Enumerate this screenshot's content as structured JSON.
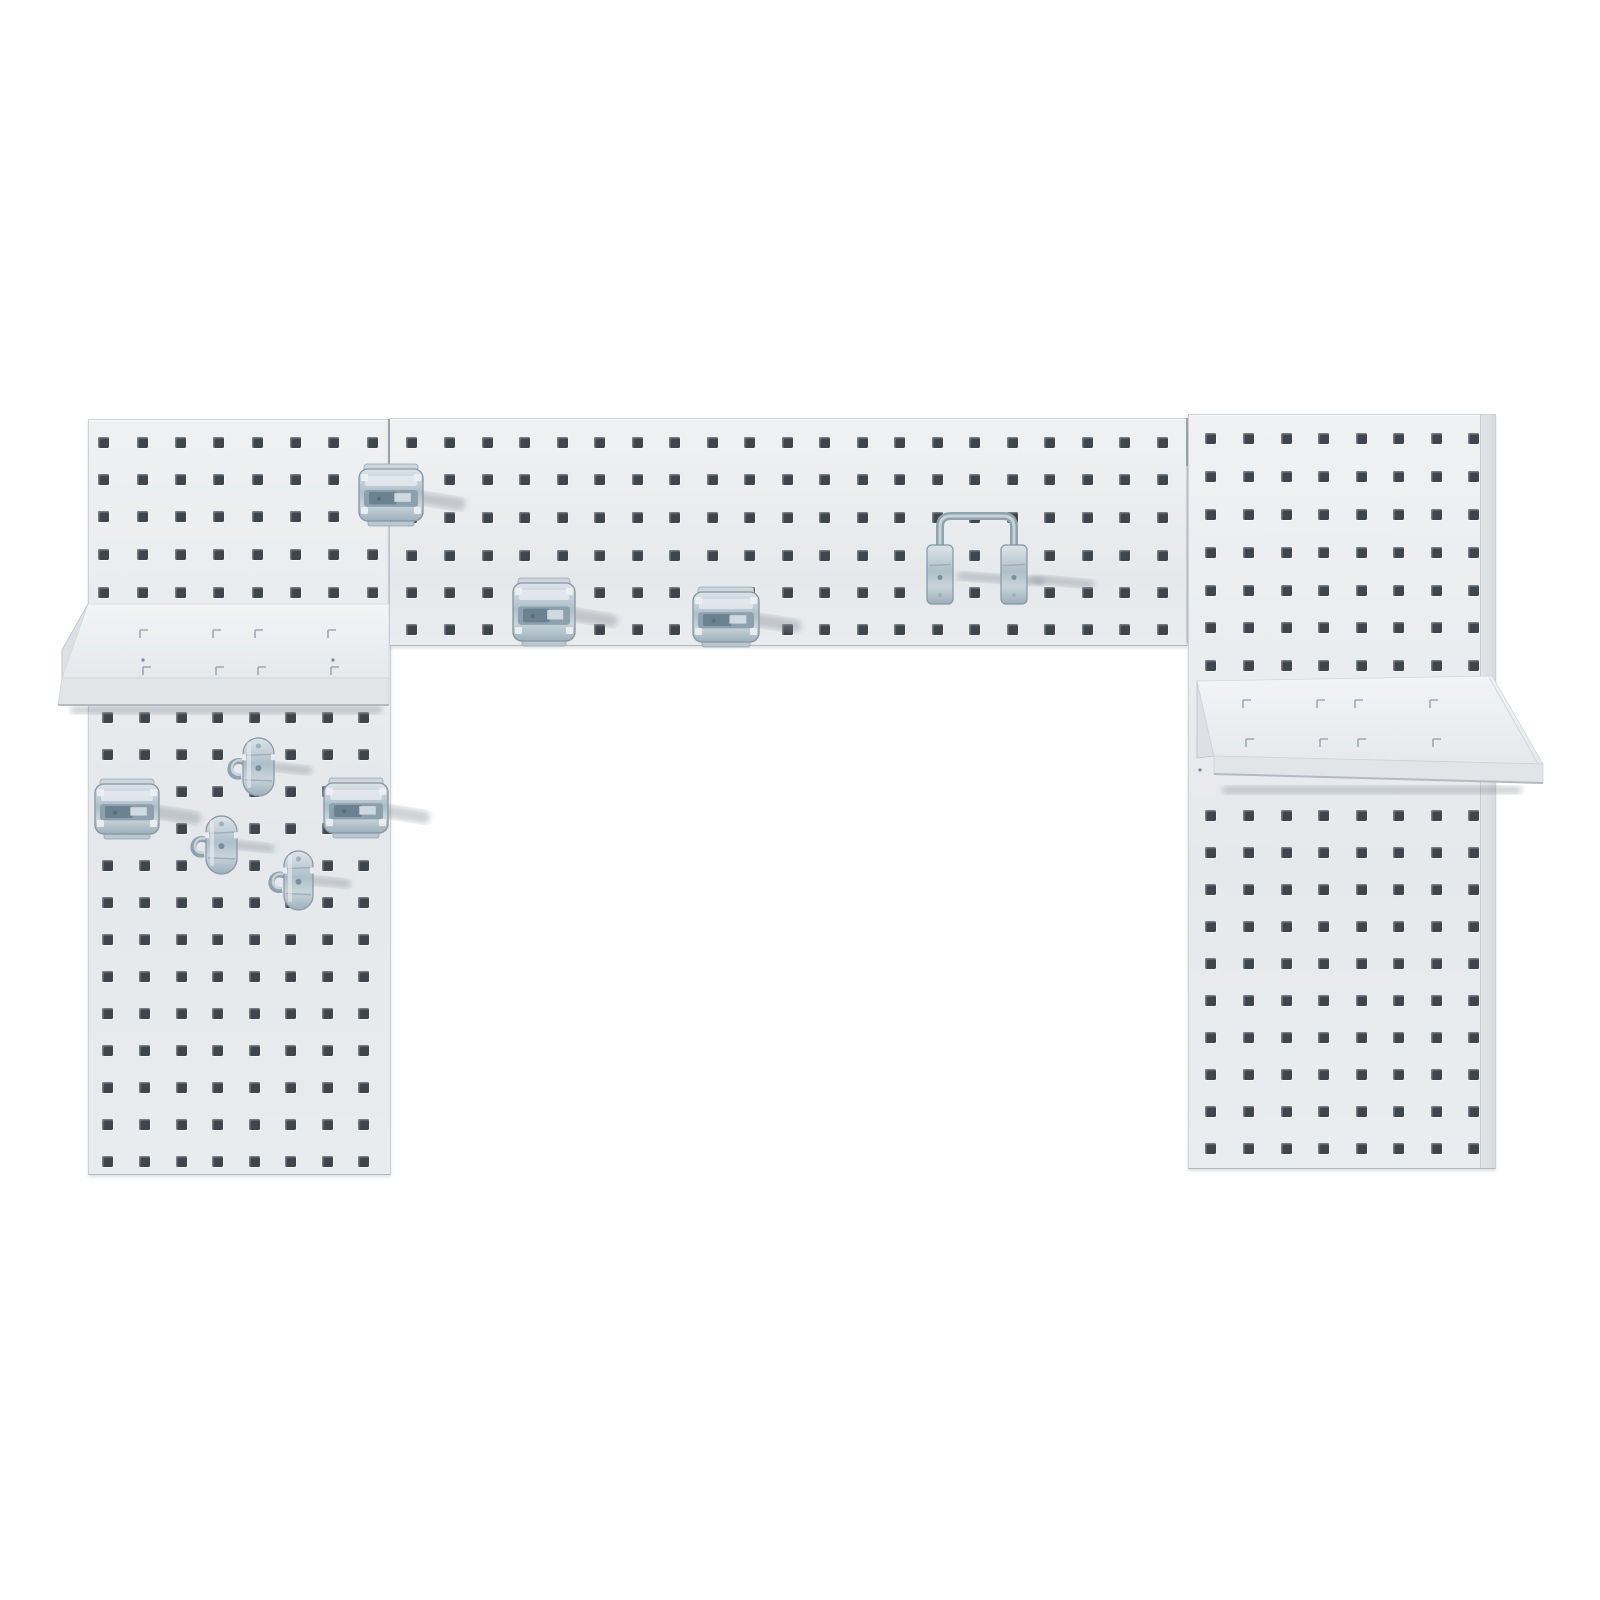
{
  "scene": {
    "background_color": "#ffffff",
    "board_color": "#e9ebed",
    "board_edge_color": "#ccd1d6",
    "hole_color": "#3f454c",
    "metal_light": "#dce4e9",
    "metal_mid": "#aebfc9",
    "metal_dark": "#8fa2ae",
    "shadow_color": "rgba(128,138,148,0.38)"
  },
  "logo": {
    "text": "LocBoard",
    "tagline": "A TRITON METAL PRODUCTS INNOVATION",
    "color": "#4a74b2",
    "tagline_color": "#5f6a76"
  },
  "panels": [
    {
      "name": "pegboard-panel-left",
      "x": 88,
      "y": 419,
      "w": 301,
      "h": 754,
      "bg": "linear-gradient(180deg,#eef0f2,#e5e8eb 55%,#e9ecee)"
    },
    {
      "name": "pegboard-panel-center",
      "x": 389,
      "y": 418,
      "w": 797,
      "h": 226,
      "bg": "linear-gradient(180deg,#f0f1f3,#e6e9eb 70%,#e9ebee)"
    },
    {
      "name": "pegboard-panel-right",
      "x": 1188,
      "y": 414,
      "w": 306,
      "h": 753,
      "bg": "linear-gradient(180deg,#eff1f3,#e6e9ec 60%,#eaedef)",
      "flange_w": 14
    }
  ],
  "hole": {
    "size": 11
  },
  "hole_grids": [
    {
      "name": "holes-left-upper",
      "cols": [
        98,
        137,
        175,
        213,
        252,
        290,
        328,
        367
      ],
      "rows": [
        437,
        474,
        511,
        549,
        587
      ]
    },
    {
      "name": "holes-left-lower",
      "cols": [
        102,
        139,
        176,
        212,
        249,
        285,
        322,
        358
      ],
      "rows": [
        712,
        749,
        786,
        823,
        860,
        897,
        934,
        971,
        1008,
        1045,
        1082,
        1119,
        1156
      ]
    },
    {
      "name": "holes-center",
      "cols": [
        406,
        444,
        482,
        519,
        557,
        594,
        632,
        669,
        707,
        744,
        782,
        819,
        857,
        894,
        932,
        969,
        1007,
        1044,
        1082,
        1119,
        1157
      ],
      "rows": [
        437,
        474,
        512,
        550,
        587,
        624
      ]
    },
    {
      "name": "holes-right-upper",
      "cols": [
        1205,
        1243,
        1281,
        1318,
        1356,
        1393,
        1431,
        1468
      ],
      "rows": [
        433,
        471,
        509,
        547,
        585,
        622,
        660
      ]
    },
    {
      "name": "holes-right-lower",
      "cols": [
        1205,
        1243,
        1281,
        1318,
        1356,
        1393,
        1431,
        1468
      ],
      "rows": [
        810,
        847,
        884,
        921,
        958,
        995,
        1032,
        1069,
        1106,
        1143
      ]
    }
  ],
  "seams": [
    {
      "name": "panel-seam-left-center",
      "x": 389,
      "y1": 419,
      "y2": 643
    },
    {
      "name": "panel-seam-center-right",
      "x": 1187,
      "y1": 418,
      "y2": 643
    }
  ],
  "shelves": [
    {
      "name": "metal-shelf-left",
      "surface": "88,604 389,604 389,678 62,678",
      "lip": "62,678 389,678 389,705 58,705",
      "lip_bottom": "58,705 389,705",
      "bracket": "88,604 88,678 62,678 62,650",
      "shadow": {
        "x": 70,
        "y": 706,
        "w": 312,
        "h": 8
      },
      "slot_rows": [
        {
          "y": 630,
          "xs": [
            140,
            213,
            255,
            328
          ]
        },
        {
          "y": 667,
          "xs": [
            143,
            216,
            258,
            331
          ]
        }
      ],
      "dots": [
        {
          "x": 143,
          "y": 660
        },
        {
          "x": 333,
          "y": 660
        }
      ]
    },
    {
      "name": "metal-shelf-right",
      "surface": "1197,681 1492,676 1543,764 1214,756",
      "lip": "1214,756 1543,764 1543,783 1214,774",
      "lip_bottom": "1214,774 1543,783",
      "bracket": "1197,681 1214,756 1197,758",
      "fold_line": "1489,677 1538,764",
      "shadow": {
        "x": 1222,
        "y": 786,
        "w": 300,
        "h": 8
      },
      "slot_rows": [
        {
          "y": 700,
          "xs": [
            1243,
            1317,
            1355,
            1430
          ]
        },
        {
          "y": 739,
          "xs": [
            1246,
            1320,
            1358,
            1433
          ]
        }
      ],
      "dots": [
        {
          "x": 1200,
          "y": 770
        }
      ]
    }
  ],
  "hooks": [
    {
      "type": "latch",
      "name": "latch-hook-top-seam",
      "x": 358,
      "y": 464,
      "w": 66,
      "h": 62
    },
    {
      "type": "latch",
      "name": "latch-hook-center-left",
      "x": 512,
      "y": 578,
      "w": 64,
      "h": 68
    },
    {
      "type": "latch",
      "name": "latch-hook-center-right",
      "x": 692,
      "y": 587,
      "w": 68,
      "h": 60
    },
    {
      "type": "uholder",
      "name": "u-shaped-tool-holder",
      "x1": 927,
      "x2": 1001,
      "y": 545,
      "bw": 26,
      "bh": 59,
      "loop_top": 516
    },
    {
      "type": "latch",
      "name": "latch-hook-lower-left-1",
      "x": 94,
      "y": 779,
      "w": 66,
      "h": 60
    },
    {
      "type": "latch",
      "name": "latch-hook-lower-left-2",
      "x": 323,
      "y": 778,
      "w": 66,
      "h": 60
    },
    {
      "type": "oval",
      "name": "curl-hook-upper",
      "x": 243,
      "y": 738,
      "w": 31,
      "h": 58
    },
    {
      "type": "oval",
      "name": "curl-hook-middle",
      "x": 206,
      "y": 816,
      "w": 31,
      "h": 58
    },
    {
      "type": "oval",
      "name": "curl-hook-lower",
      "x": 284,
      "y": 851,
      "w": 29,
      "h": 59
    }
  ]
}
